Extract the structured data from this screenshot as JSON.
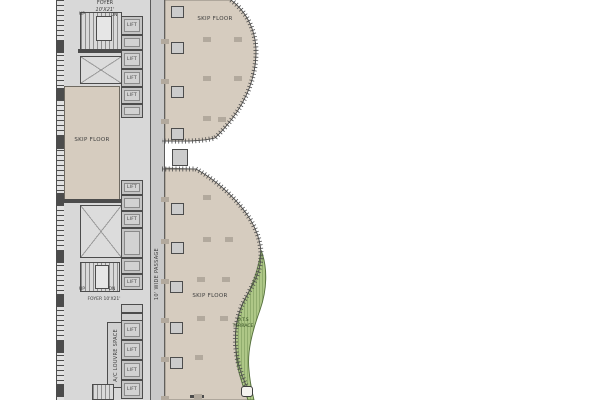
{
  "labels": {
    "lift": "LIFT",
    "skip_floor": "SKIP FLOOR",
    "passage": "10' WIDE PASSAGE",
    "ac_space": "A/C LOUVRE SPACE",
    "terrace": {
      "line1": "O.T.S",
      "line2": "TERRACE"
    },
    "foyer_top": {
      "line1": "FOYER",
      "line2": "10'X21'"
    },
    "foyer_bottom": "FOYER 10'X21'",
    "up": "UP",
    "dn": "DN"
  },
  "colors": {
    "floor_beige": "#d6ccbf",
    "core_gray": "#d8d8d8",
    "passage_gray": "#c9c9c9",
    "wall_dark": "#4c4c4c",
    "terrace_green": "#aec787",
    "terrace_hatch": "#8aa768",
    "terrace_border": "#55703d"
  },
  "lifts": [
    {
      "y": 16,
      "h": 19,
      "labeled": true
    },
    {
      "y": 35,
      "h": 15,
      "labeled": false
    },
    {
      "y": 50,
      "h": 19,
      "labeled": true
    },
    {
      "y": 69,
      "h": 18,
      "labeled": true
    },
    {
      "y": 87,
      "h": 17,
      "labeled": true
    },
    {
      "y": 104,
      "h": 14,
      "labeled": false
    },
    {
      "y": 180,
      "h": 15,
      "labeled": true
    },
    {
      "y": 195,
      "h": 16,
      "labeled": false
    },
    {
      "y": 211,
      "h": 17,
      "labeled": true
    },
    {
      "y": 228,
      "h": 30,
      "labeled": false
    },
    {
      "y": 258,
      "h": 16,
      "labeled": false
    },
    {
      "y": 274,
      "h": 16,
      "labeled": true
    },
    {
      "y": 320,
      "h": 20,
      "labeled": true
    },
    {
      "y": 340,
      "h": 20,
      "labeled": true
    },
    {
      "y": 360,
      "h": 20,
      "labeled": true
    },
    {
      "y": 380,
      "h": 19,
      "labeled": true
    }
  ],
  "columns": {
    "squares": [
      [
        171,
        6
      ],
      [
        171,
        42
      ],
      [
        171,
        86
      ],
      [
        171,
        128
      ],
      [
        171,
        203
      ],
      [
        171,
        242
      ],
      [
        170,
        281
      ],
      [
        170,
        322
      ],
      [
        170,
        357
      ]
    ],
    "gap_square": {
      "x": 172,
      "y": 149,
      "w": 16,
      "h": 17
    },
    "stubs": [
      [
        203,
        37
      ],
      [
        234,
        37
      ],
      [
        161,
        39
      ],
      [
        203,
        76
      ],
      [
        234,
        76
      ],
      [
        161,
        79
      ],
      [
        203,
        116
      ],
      [
        218,
        117
      ],
      [
        161,
        119
      ],
      [
        203,
        195
      ],
      [
        161,
        197
      ],
      [
        203,
        237
      ],
      [
        225,
        237
      ],
      [
        161,
        239
      ],
      [
        197,
        277
      ],
      [
        222,
        277
      ],
      [
        161,
        279
      ],
      [
        197,
        316
      ],
      [
        220,
        316
      ],
      [
        161,
        318
      ],
      [
        195,
        355
      ],
      [
        161,
        357
      ],
      [
        194,
        394
      ],
      [
        161,
        396
      ]
    ]
  },
  "wall_piers": [
    40,
    88,
    136,
    193,
    250,
    294,
    340,
    384
  ]
}
